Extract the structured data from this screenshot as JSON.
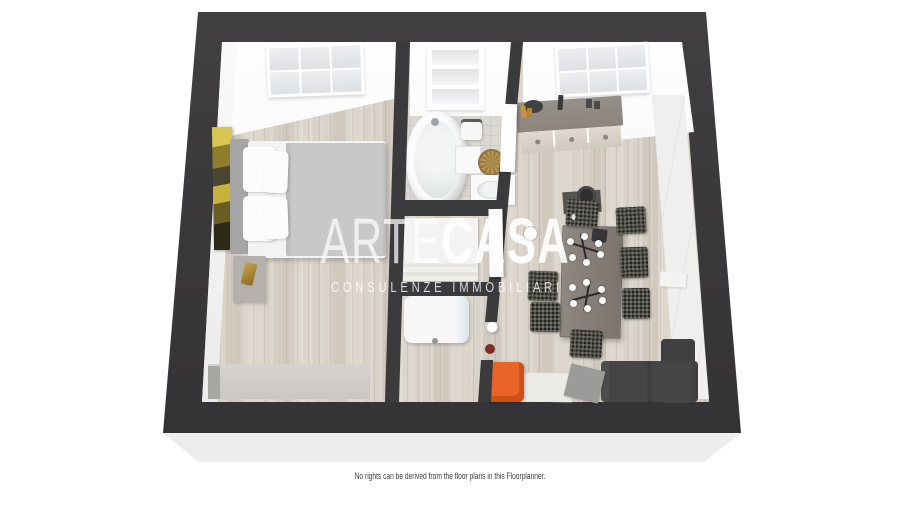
{
  "watermark": {
    "brand_light": "ARTE",
    "brand_bold": "CASA",
    "registered_mark": "®",
    "tagline": "CONSULENZE IMMOBILIARI"
  },
  "footer": {
    "disclaimer": "No rights can be derived from the floor plans in this Floorplanner."
  },
  "colors": {
    "page_bg": "#ffffff",
    "wall": "#3b3a3c",
    "base": "#f4f4f4",
    "wood": "#d8d1c7",
    "tile": "#dbd8d4",
    "watermark": "#ffffff",
    "orange": "#e86325",
    "sofa": "#454447",
    "chair": "#23221e",
    "table": "#87807a",
    "counter": "#8b857d",
    "cabinet": "#d7d1c7",
    "wardrobe": "#f0efed",
    "dresser": "#cac7c2",
    "blanket": "#c8c8ca",
    "basket": "#b69659",
    "gold": "#c9a24a",
    "painting": "#a8902e"
  },
  "floorplan": {
    "view": "3d-top-down-apartment",
    "dining_chair_count": 7,
    "rooms": [
      {
        "name": "bedroom",
        "furniture": [
          "double-bed",
          "pillows",
          "headboard",
          "nightstand",
          "wall-art",
          "dresser",
          "window"
        ]
      },
      {
        "name": "bathroom",
        "furniture": [
          "bathtub",
          "towel-shelf",
          "bath-scale",
          "bath-mat",
          "wicker-basket",
          "sink-vanity",
          "door"
        ]
      },
      {
        "name": "hallway",
        "furniture": [
          "closet"
        ]
      },
      {
        "name": "laundry",
        "furniture": [
          "washing-machine",
          "door"
        ]
      },
      {
        "name": "living-kitchen",
        "furniture": [
          "kitchen-counter",
          "kitchen-sink",
          "window",
          "tall-wardrobe",
          "dining-table",
          "dining-chairs",
          "candle-decor",
          "stool",
          "sofa",
          "chaise",
          "rug",
          "media-table",
          "orange-armchair",
          "floor-lamp",
          "vase",
          "bench"
        ]
      }
    ]
  }
}
